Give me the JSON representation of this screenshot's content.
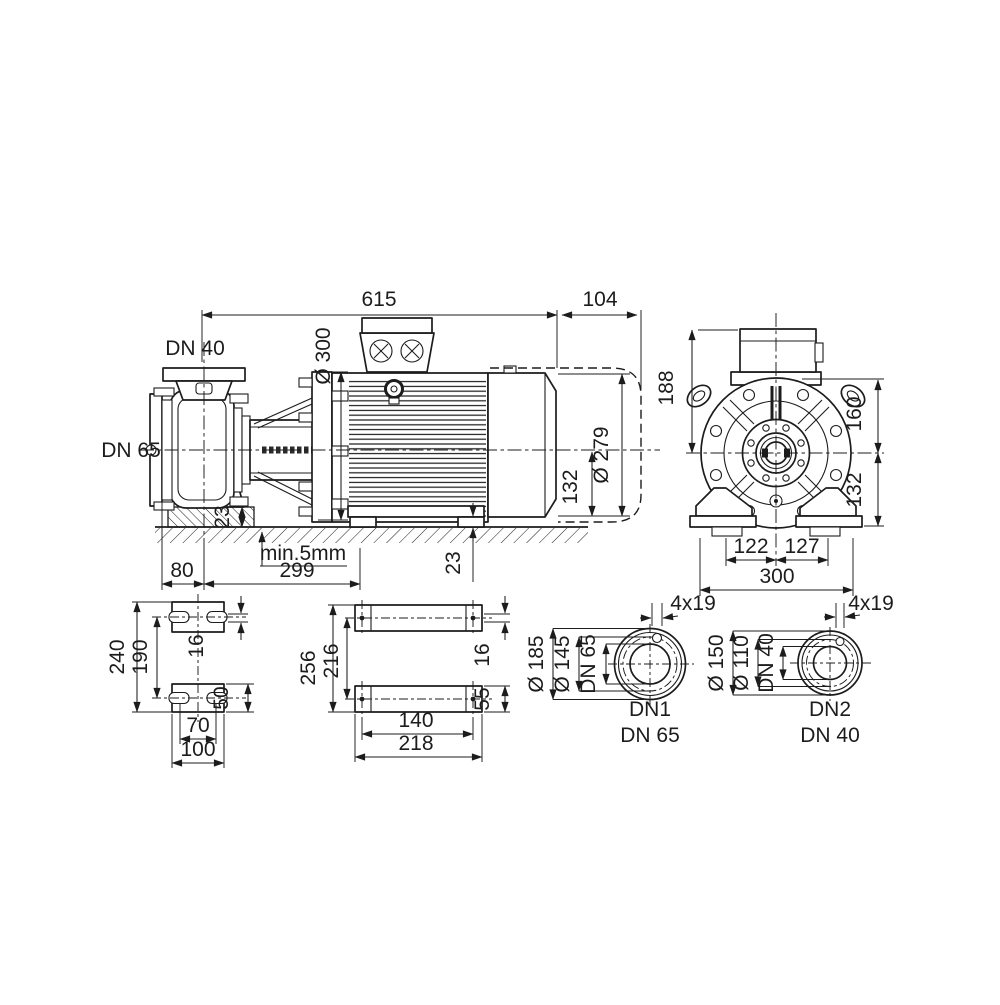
{
  "colors": {
    "line": "#1c1c1c",
    "background": "#ffffff"
  },
  "side": {
    "len_main": "615",
    "len_ext": "104",
    "port_top": "DN 40",
    "port_left": "DN 65",
    "dia_flange": "Ø 300",
    "dia_motor": "Ø 279",
    "h_center": "132",
    "h_pump_foot": "23",
    "h_motor_foot": "23",
    "shim": "min.5mm",
    "off_suction": "80",
    "len_foot": "299"
  },
  "end": {
    "h_box": "188",
    "h_top": "160",
    "h_bottom": "132",
    "foot_l": "122",
    "foot_r": "127",
    "width": "300"
  },
  "pump_foot": {
    "overall": "240",
    "centers": "190",
    "slot": "16",
    "h_foot": "50",
    "holes": "70",
    "width": "100"
  },
  "motor_foot": {
    "overall": "256",
    "centers": "216",
    "slot": "16",
    "h_foot": "55",
    "holes": "140",
    "width": "218"
  },
  "flange1": {
    "d_outer": "Ø 185",
    "d_bolt": "Ø 145",
    "bore": "DN 65",
    "holes": "4x19",
    "name": "DN1",
    "size": "DN 65"
  },
  "flange2": {
    "d_outer": "Ø 150",
    "d_bolt": "Ø 110",
    "bore": "DN 40",
    "holes": "4x19",
    "name": "DN2",
    "size": "DN 40"
  }
}
